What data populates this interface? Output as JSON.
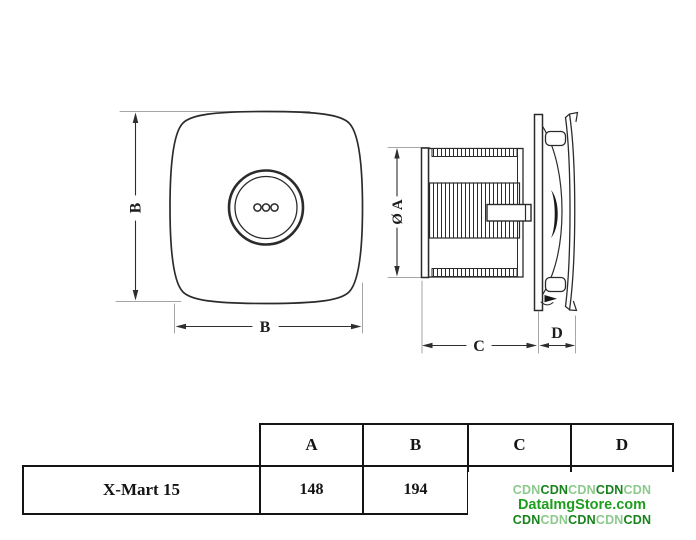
{
  "diagram": {
    "front_view": {
      "height_dim_label": "B",
      "width_dim_label": "B"
    },
    "side_view": {
      "diameter_dim_label": "Ø A",
      "body_depth_dim_label": "C",
      "panel_depth_dim_label": "D"
    }
  },
  "table": {
    "columns": [
      "A",
      "B",
      "C",
      "D"
    ],
    "rows": [
      {
        "model": "X-Mart 15",
        "A": "148",
        "B": "194",
        "C": "",
        "D": ""
      }
    ]
  },
  "watermark": {
    "line1_parts": [
      "CDN",
      "CDN",
      "CDN",
      "CDN",
      "CDN"
    ],
    "line2": "DataImgStore.com",
    "line3_parts": [
      "CDN",
      "CDN",
      "CDN",
      "CDN",
      "CDN"
    ],
    "colors": {
      "light_green": "#8CC98C",
      "dark_green": "#17821C",
      "brand_green": "#1E9E1E"
    }
  }
}
